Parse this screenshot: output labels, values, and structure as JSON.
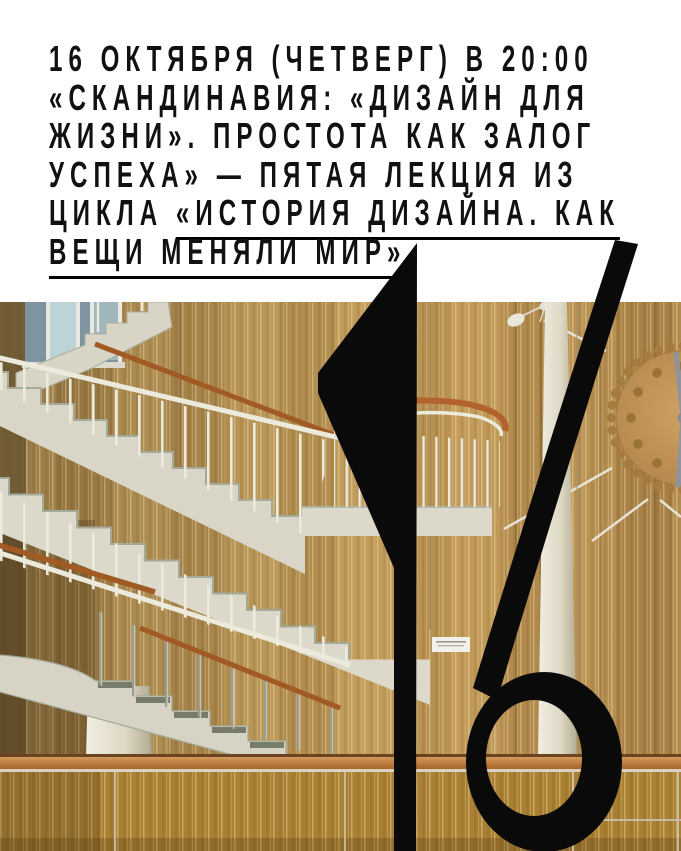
{
  "poster": {
    "headline": {
      "line1": "16 ОКТЯБРЯ (ЧЕТВЕРГ) В 20:00",
      "line2": "«СКАНДИНАВИЯ: «ДИЗАЙН ДЛЯ",
      "line3": "ЖИЗНИ». ПРОСТОТА КАК ЗАЛОГ",
      "line4": "УСПЕХА» — ПЯТАЯ ЛЕКЦИЯ ИЗ",
      "line5_plain": "ЦИКЛА ",
      "line5_underlined": "«ИСТОРИЯ ДИЗАЙНА. КАК",
      "line6_underlined": "ВЕЩИ МЕНЯЛИ МИР»"
    },
    "date_numeral": "16",
    "colors": {
      "background": "#ffffff",
      "text": "#111111",
      "numeral": "#0a0a0a",
      "wood_wall": "#b79354",
      "wood_dark": "#6d5833",
      "stair_concrete": "#d9d6c8",
      "stair_shadow": "#a4aa99",
      "handrail_wood": "#a25a24",
      "railing_white": "#eceadc",
      "column_cream": "#e9e4d2",
      "clock_face": "#c39658",
      "clock_hands": "#8e949c",
      "parapet_cap": "#b06a2c"
    }
  }
}
